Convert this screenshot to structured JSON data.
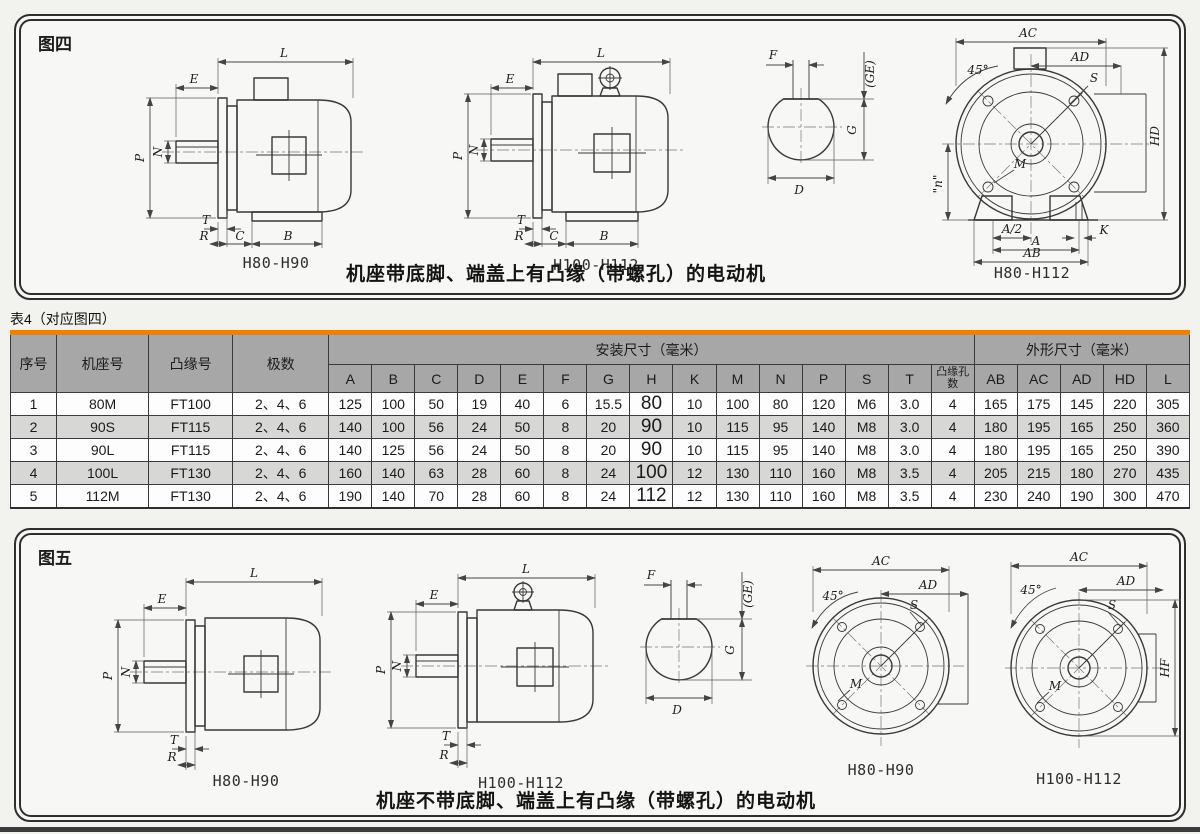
{
  "page": {
    "figure4": {
      "label": "图四",
      "caption": "机座带底脚、端盖上有凸缘（带螺孔）的电动机",
      "side1_label": "H80-H90",
      "side2_label": "H100-H112",
      "front_label": "H80-H112"
    },
    "figure5": {
      "label": "图五",
      "caption": "机座不带底脚、端盖上有凸缘（带螺孔）的电动机",
      "side1_label": "H80-H90",
      "side2_label": "H100-H112",
      "front1_label": "H80-H90",
      "front2_label": "H100-H112"
    },
    "dims": {
      "L": "L",
      "E": "E",
      "P": "P",
      "N": "N",
      "T": "T",
      "R": "R",
      "C": "C",
      "B": "B",
      "F": "F",
      "GE": "(GE)",
      "G": "G",
      "D": "D",
      "AC": "AC",
      "AD": "AD",
      "S": "S",
      "HD": "HD",
      "M": "M",
      "n": "\"n\"",
      "A2": "A/2",
      "K": "K",
      "A": "A",
      "AB": "AB",
      "HF": "HF",
      "angle45": "45°"
    },
    "table": {
      "title": "表4（对应图四）",
      "main_headers": [
        "序号",
        "机座号",
        "凸缘号",
        "极数"
      ],
      "group_headers": {
        "install": "安装尺寸（毫米）",
        "outline": "外形尺寸（毫米）"
      },
      "sub_headers": [
        "A",
        "B",
        "C",
        "D",
        "E",
        "F",
        "G",
        "H",
        "K",
        "M",
        "N",
        "P",
        "S",
        "T",
        "凸缘孔数",
        "AB",
        "AC",
        "AD",
        "HD",
        "L"
      ],
      "rows": [
        [
          "1",
          "80M",
          "FT100",
          "2、4、6",
          "125",
          "100",
          "50",
          "19",
          "40",
          "6",
          "15.5",
          "80",
          "10",
          "100",
          "80",
          "120",
          "M6",
          "3.0",
          "4",
          "165",
          "175",
          "145",
          "220",
          "305"
        ],
        [
          "2",
          "90S",
          "FT115",
          "2、4、6",
          "140",
          "100",
          "56",
          "24",
          "50",
          "8",
          "20",
          "90",
          "10",
          "115",
          "95",
          "140",
          "M8",
          "3.0",
          "4",
          "180",
          "195",
          "165",
          "250",
          "360"
        ],
        [
          "3",
          "90L",
          "FT115",
          "2、4、6",
          "140",
          "125",
          "56",
          "24",
          "50",
          "8",
          "20",
          "90",
          "10",
          "115",
          "95",
          "140",
          "M8",
          "3.0",
          "4",
          "180",
          "195",
          "165",
          "250",
          "390"
        ],
        [
          "4",
          "100L",
          "FT130",
          "2、4、6",
          "160",
          "140",
          "63",
          "28",
          "60",
          "8",
          "24",
          "100",
          "12",
          "130",
          "110",
          "160",
          "M8",
          "3.5",
          "4",
          "205",
          "215",
          "180",
          "270",
          "435"
        ],
        [
          "5",
          "112M",
          "FT130",
          "2、4、6",
          "190",
          "140",
          "70",
          "28",
          "60",
          "8",
          "24",
          "112",
          "12",
          "130",
          "110",
          "160",
          "M8",
          "3.5",
          "4",
          "230",
          "240",
          "190",
          "300",
          "470"
        ]
      ]
    },
    "colors": {
      "accent": "#ee7f00"
    }
  }
}
